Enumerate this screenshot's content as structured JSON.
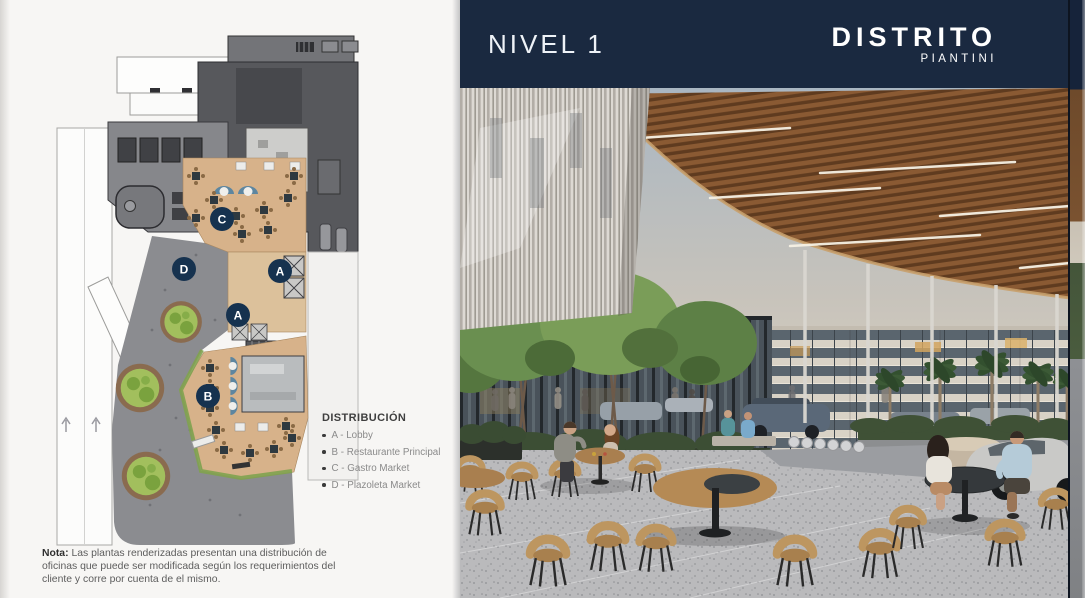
{
  "left_page": {
    "plan": {
      "markers": [
        {
          "label": "C"
        },
        {
          "label": "D"
        },
        {
          "label": "A"
        },
        {
          "label": "A"
        },
        {
          "label": "B"
        }
      ]
    },
    "legend": {
      "title": "DISTRIBUCIÓN",
      "items": [
        "A - Lobby",
        "B - Restaurante Principal",
        "C - Gastro Market",
        "D - Plazoleta Market"
      ]
    },
    "note": {
      "label": "Nota:",
      "text": "Las plantas renderizadas presentan una distribución de oficinas que puede ser modificada según los requerimientos del cliente y corre por cuenta de el mismo."
    }
  },
  "right_page": {
    "header": {
      "title": "NIVEL 1",
      "brand": "DISTRITO",
      "brand_sub": "PIANTINI"
    }
  },
  "colors": {
    "header_navy": "#1a2940",
    "marker_navy": "#16324f",
    "plan_wood": "#d7b28a",
    "plan_plaza_gray": "#8b8c90",
    "canopy_wood": "#8a5c33",
    "page_bg": "#f6f5f3"
  }
}
